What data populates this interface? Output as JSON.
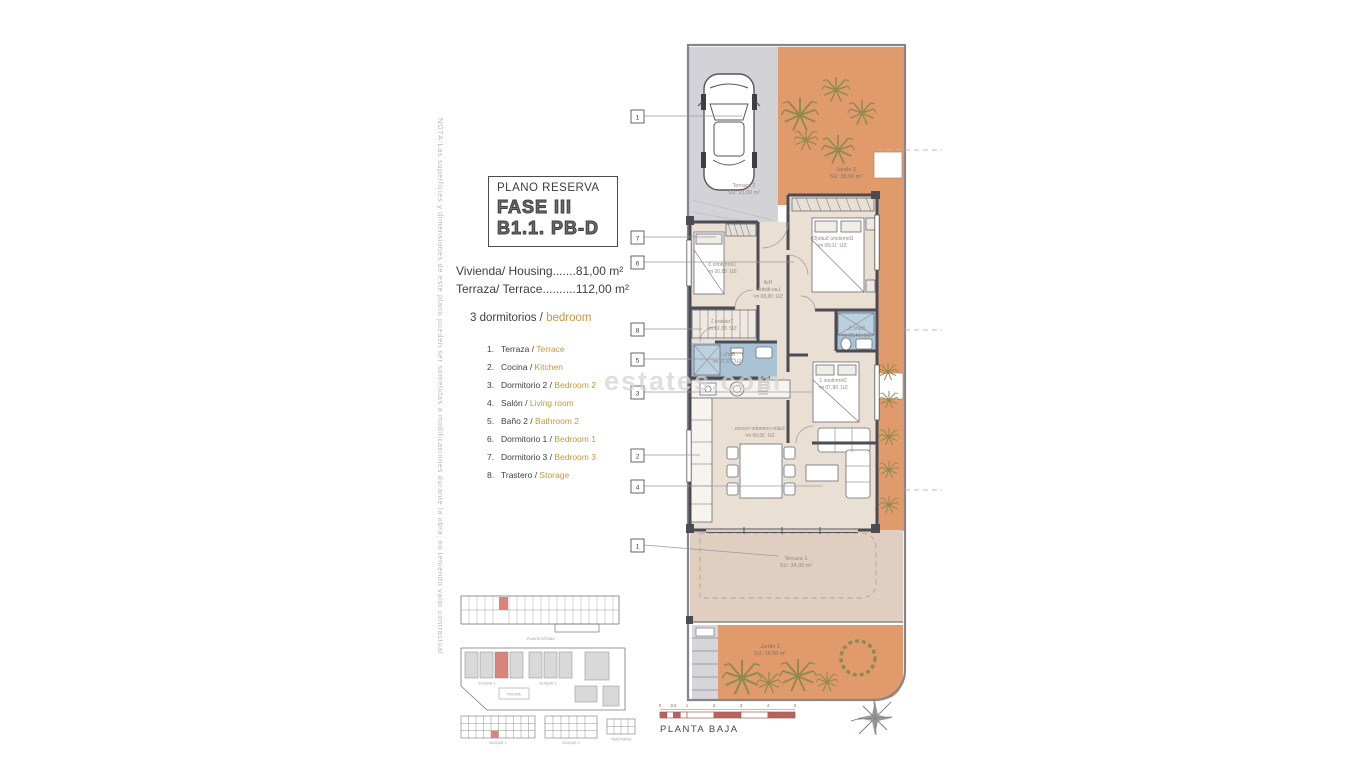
{
  "note": "NOTA:Las superficies y dimensiones de este plano pueden ser sometidas a modificaciones durante la obra, no teniendo valor contractual",
  "title_block": {
    "subtitle": "PLANO RESERVA",
    "phase": "FASE III",
    "unit": "B1.1. PB-D"
  },
  "areas": {
    "housing": "Vivienda/ Housing.......81,00 m²",
    "terrace": "Terraza/ Terrace..........112,00 m²"
  },
  "bedrooms": {
    "es": "3 dormitorios / ",
    "en": "bedroom"
  },
  "legend": [
    {
      "num": "1.",
      "es": "Terraza / ",
      "en": "Terrace"
    },
    {
      "num": "2.",
      "es": "Cocina / ",
      "en": "Kitchen"
    },
    {
      "num": "3.",
      "es": "Dormitorio 2 / ",
      "en": "Bedroom 2"
    },
    {
      "num": "4.",
      "es": "Salón / ",
      "en": "Living room"
    },
    {
      "num": "5.",
      "es": "Baño 2 / ",
      "en": "Bathroom 2"
    },
    {
      "num": "6.",
      "es": "Dormitorio 1 / ",
      "en": "Bedroom 1"
    },
    {
      "num": "7.",
      "es": "Dormitorio 3 / ",
      "en": "Bedroom 3"
    },
    {
      "num": "8.",
      "es": "Trastero / ",
      "en": "Storage"
    }
  ],
  "plan": {
    "markers": [
      "1",
      "7",
      "6",
      "8",
      "5",
      "3",
      "2",
      "4",
      "1"
    ],
    "zones": {
      "terraza2": {
        "name": "Terraza 2",
        "area": "SU: 23,00 m²"
      },
      "jardin2": {
        "name": "Jardín 2",
        "area": "SU: 36,00 m²"
      },
      "terraza1": {
        "name": "Terraza 1",
        "area": "SU: 34,00 m²"
      },
      "jardin1": {
        "name": "Jardín 1",
        "area": "SU: 18,00 m²"
      }
    },
    "rooms": {
      "dormitorio_suite": {
        "name": "Dormitorio Suite(D)",
        "area": "SU: 10,80 m²"
      },
      "dormitorio3": {
        "name": "Dormitorio 3",
        "area": "SU: 08,00 m²"
      },
      "trastero": {
        "name": "Trastero 1",
        "area": "SU: 03,10 m²"
      },
      "bano2": {
        "name": "Baño 2",
        "area": "SU: 03,70 m²"
      },
      "hall": {
        "name": "Hall",
        "line2": "Lav-distrib.",
        "area": "SU: 06,80 m²"
      },
      "bano_suite": {
        "name": "Baño S.",
        "area": "SU: 04,20 m²"
      },
      "dormitorio2": {
        "name": "Dormitorio 2",
        "area": "SU: 08,70 m²"
      },
      "salon": {
        "name": "Salón-comedor-cocina",
        "area": "SU: 30,00 m²"
      }
    }
  },
  "footer": {
    "caption": "PLANTA BAJA",
    "ticks": [
      "0",
      "0.5",
      "1",
      "2",
      "3",
      "4",
      "5"
    ]
  },
  "minimap": {
    "basement_label": "PLANTA SÓTANO",
    "site_block1": "BLOQUE 1",
    "site_block2": "BLOQUE 2",
    "pool": "PISCINA",
    "elev_block1": "BLOQUE 1",
    "elev_block2": "BLOQUE 2",
    "storage_label": "TRASTEROS"
  },
  "watermark": "estates.com",
  "colors": {
    "garden": "#e09a6c",
    "room": "#eadfd3",
    "terrace": "#e0cec0",
    "parking": "#d3d3d7",
    "wall": "#4b4b53",
    "bath": "#a9c3d6",
    "accent": "#c8963c",
    "highlight": "#d9837a",
    "scalebar": "#b4645c"
  }
}
